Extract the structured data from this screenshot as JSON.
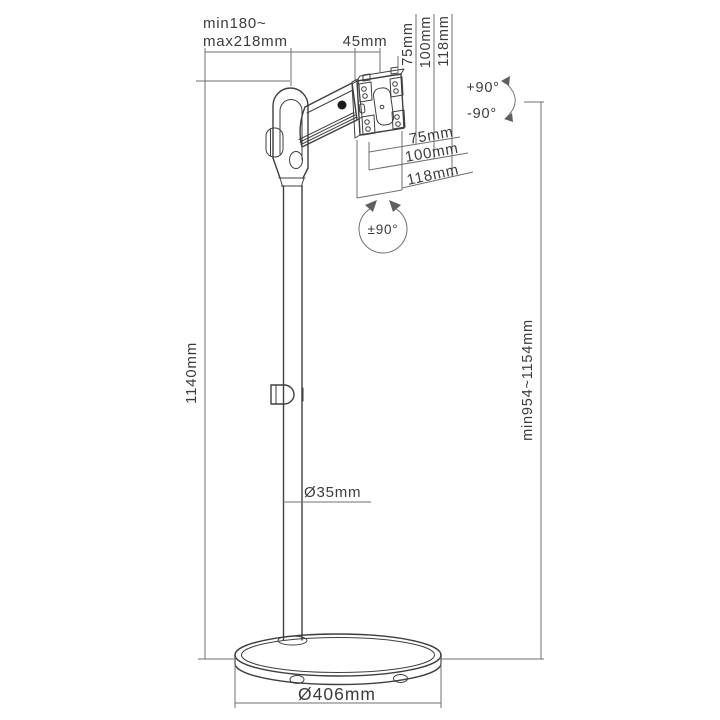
{
  "diagram": {
    "product": "monitor-floor-stand-dimension-drawing",
    "labels": {
      "arm_reach_line1": "min180~",
      "arm_reach_line2": "max218mm",
      "bracket_depth": "45mm",
      "vesa_col": [
        "75mm",
        "100mm",
        "118mm"
      ],
      "vesa_row": [
        "75mm",
        "100mm",
        "118mm"
      ],
      "tilt_up": "+90°",
      "tilt_down": "-90°",
      "rotate_range": "±90°",
      "pole_height": "1140mm",
      "vesa_height_range": "min954~1154mm",
      "pole_diameter": "Ø35mm",
      "base_diameter": "Ø406mm"
    },
    "colors": {
      "artwork_line": "#3f3f3f",
      "dimension_line": "#6f6f6f",
      "text": "#3c3c3c",
      "pivot_fill": "#1c1c1c",
      "background": "#ffffff"
    }
  }
}
